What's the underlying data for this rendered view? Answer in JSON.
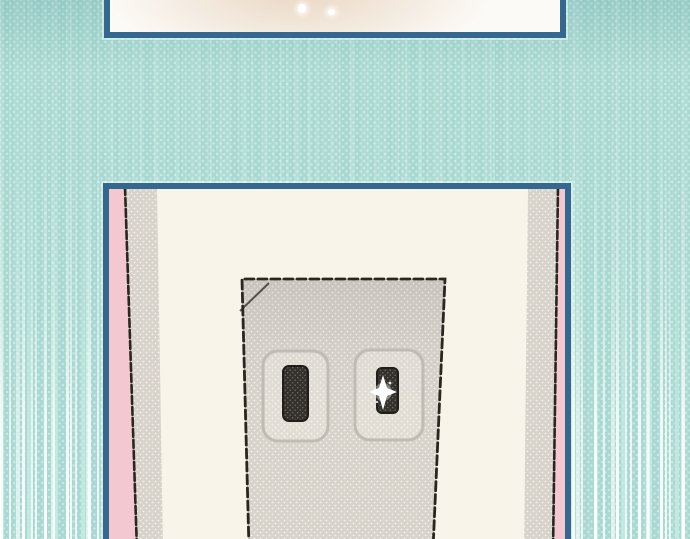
{
  "page": {
    "description": "Webtoon comic page segment: teal halftone background with vertical speed lines and two blue-bordered panels; the lower panel shows a close-up of a two-slot wall power outlet with a sparkle glint on the right slot.",
    "visible_text": []
  },
  "colors": {
    "bg-teal": "#a8d8d1",
    "bg-dot": "#c8e9e2",
    "panel-border": "#35688e",
    "panel-white": "#fcfaf7",
    "glow-beige": "#e9d8c4",
    "wall-cream": "#f8f4e9",
    "side-pink": "#f3c8d1",
    "halftone-gray": "#d7d3cb",
    "slot-dark": "#34312c",
    "ink-dark": "#2a2620",
    "recess-stroke": "#c0bcb3",
    "speed-white": "#ffffff"
  },
  "scene": {
    "background": "teal halftone dots with white vertical speed lines intensifying toward bottom",
    "panels": [
      {
        "name": "top-panel",
        "content": "cropped panel showing a soft warm beige blur with two tiny white sparkles"
      },
      {
        "name": "bottom-panel",
        "content": "wall power outlet close-up between pink-and-gray wall edges; left slot dark, right slot glinting with a four-point sparkle"
      }
    ]
  }
}
